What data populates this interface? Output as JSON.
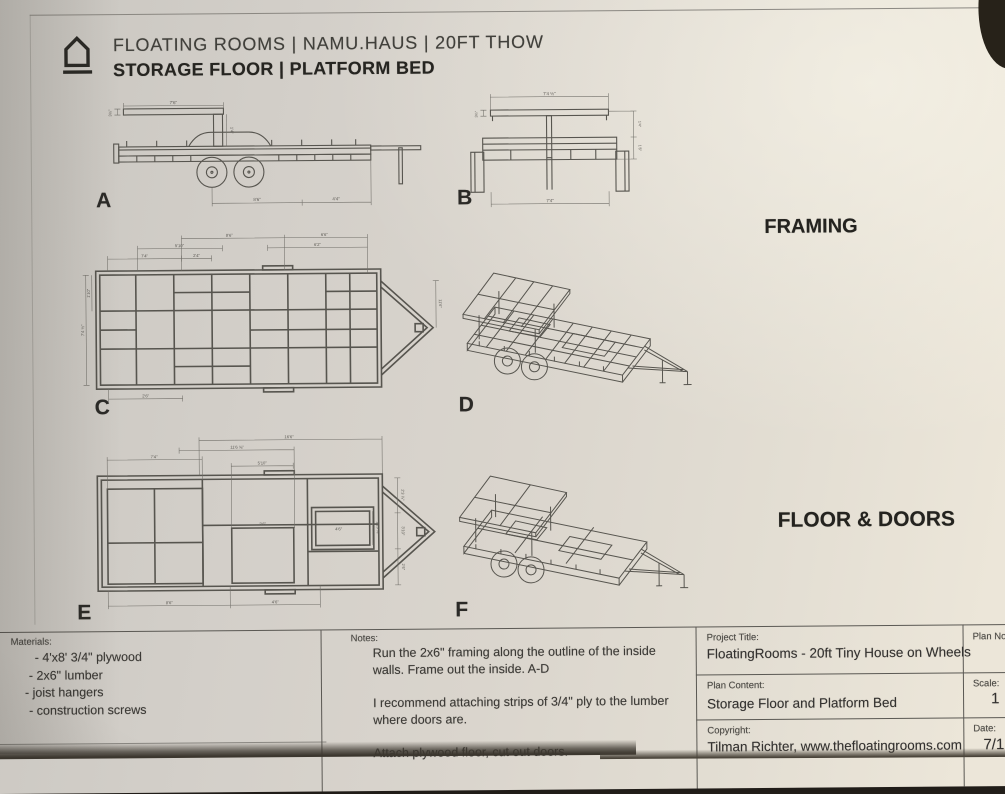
{
  "header": {
    "logo": "house-icon",
    "line1": "FLOATING ROOMS | NAMU.HAUS | 20FT THOW",
    "line2": "STORAGE FLOOR | PLATFORM BED"
  },
  "sections": {
    "framing": "FRAMING",
    "floor_doors": "FLOOR & DOORS"
  },
  "drawings": {
    "a": {
      "label": "A",
      "dims": [
        "7'6\"",
        "3½\"",
        "1'4\"",
        "8'6\"",
        "4'4\""
      ]
    },
    "b": {
      "label": "B",
      "dims": [
        "7'4 ½\"",
        "3½\"",
        "1'4\"",
        "1'6\"",
        "7'4\""
      ]
    },
    "c": {
      "label": "C",
      "dims": [
        "8'6\"",
        "6'6\"",
        "5'10\"",
        "7'4\"",
        "2'4\"",
        "6'2\"",
        "11'6\"",
        "1'10\"",
        "7'4 ½\"",
        "2'6\""
      ]
    },
    "d": {
      "label": "D"
    },
    "e": {
      "label": "E",
      "dims": [
        "16'6\"",
        "11'6 ⅝\"",
        "7'4\"",
        "5'10\"",
        "2'6\"",
        "4'6\"",
        "1'10 ⅝\"",
        "8'6\"",
        "4'6\"",
        "2'3 ⅞\"",
        "3'10\"",
        "2'6\""
      ]
    },
    "f": {
      "label": "F"
    }
  },
  "title_block": {
    "materials": {
      "label": "Materials:",
      "items": [
        "- 4'x8' 3/4\" plywood",
        "- 2x6\" lumber",
        "- joist hangers",
        "- construction screws"
      ]
    },
    "notes": {
      "label": "Notes:",
      "paragraphs": [
        "Run the 2x6\" framing along the outline of the inside walls. Frame out the inside. A-D",
        "I recommend attaching strips of 3/4\" ply to the lumber where doors are.",
        "Attach plywood floor, cut out doors."
      ]
    },
    "project_title": {
      "label": "Project Title:",
      "value": "FloatingRooms - 20ft Tiny House on Wheels"
    },
    "plan_content": {
      "label": "Plan Content:",
      "value": "Storage Floor and Platform Bed"
    },
    "copyright": {
      "label": "Copyright:",
      "value": "Tilman Richter, www.thefloatingrooms.com"
    },
    "plan_no": {
      "label": "Plan No.:",
      "value": ""
    },
    "scale": {
      "label": "Scale:",
      "value": "1"
    },
    "date": {
      "label": "Date:",
      "value": "7/1"
    }
  },
  "colors": {
    "paper": "#dad5cd",
    "ink": "#3c3a36",
    "line": "#57554f"
  }
}
